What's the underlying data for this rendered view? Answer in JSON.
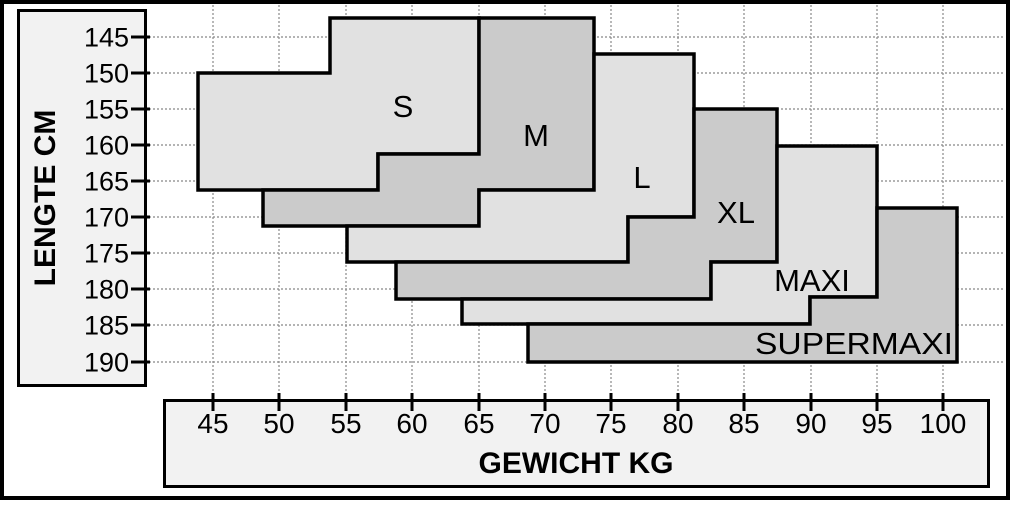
{
  "axes": {
    "y": {
      "title": "LENGTE CM",
      "unit": "cm",
      "ticks": [
        {
          "label": "145",
          "px": 37
        },
        {
          "label": "150",
          "px": 73
        },
        {
          "label": "155",
          "px": 109
        },
        {
          "label": "160",
          "px": 145
        },
        {
          "label": "165",
          "px": 181
        },
        {
          "label": "170",
          "px": 217
        },
        {
          "label": "175",
          "px": 253
        },
        {
          "label": "180",
          "px": 289
        },
        {
          "label": "185",
          "px": 325
        },
        {
          "label": "190",
          "px": 362
        }
      ]
    },
    "x": {
      "title": "GEWICHT KG",
      "unit": "kg",
      "ticks": [
        {
          "label": "45",
          "px": 213
        },
        {
          "label": "50",
          "px": 279
        },
        {
          "label": "55",
          "px": 346
        },
        {
          "label": "60",
          "px": 412
        },
        {
          "label": "65",
          "px": 479
        },
        {
          "label": "70",
          "px": 545
        },
        {
          "label": "75",
          "px": 611
        },
        {
          "label": "80",
          "px": 678
        },
        {
          "label": "85",
          "px": 744
        },
        {
          "label": "90",
          "px": 811
        },
        {
          "label": "95",
          "px": 877
        },
        {
          "label": "100",
          "px": 943
        }
      ]
    }
  },
  "colors": {
    "region_light": "#e1e1e1",
    "region_dark": "#cbcbcb",
    "axis_box": "#f2f2f2",
    "grid": "#888888",
    "line": "#000000",
    "background": "#ffffff"
  },
  "grid": {
    "h_x1": 149,
    "h_x2": 1005,
    "v_y1": 5,
    "v_y2": 399,
    "left_tick_x1": 131,
    "left_tick_x2": 150,
    "bottom_tick_y1": 393,
    "bottom_tick_y2": 411
  },
  "chart_data": {
    "type": "area",
    "subtype": "stepped-size-regions",
    "title": "",
    "xlabel": "GEWICHT KG",
    "ylabel": "LENGTE CM",
    "x_domain": [
      45,
      100
    ],
    "y_domain": [
      145,
      190
    ],
    "y_inverted": true,
    "grid": "dashed, on both axes at every 5 units",
    "legend_position": "labels inside regions",
    "regions": [
      {
        "name": "S",
        "shade": "light",
        "points_px": [
          [
            198,
            73
          ],
          [
            330,
            73
          ],
          [
            330,
            18
          ],
          [
            479,
            18
          ],
          [
            479,
            154
          ],
          [
            378,
            154
          ],
          [
            378,
            190
          ],
          [
            198,
            190
          ]
        ],
        "points_data_kg_cm": [
          [
            44,
            150
          ],
          [
            54,
            150
          ],
          [
            54,
            142.5
          ],
          [
            65,
            142.5
          ],
          [
            65,
            161
          ],
          [
            57.5,
            161
          ],
          [
            57.5,
            166.5
          ],
          [
            44,
            166.5
          ]
        ],
        "label_px": [
          403,
          117
        ]
      },
      {
        "name": "M",
        "shade": "dark",
        "points_px": [
          [
            479,
            18
          ],
          [
            594,
            18
          ],
          [
            594,
            190
          ],
          [
            479,
            190
          ],
          [
            479,
            226
          ],
          [
            263,
            226
          ],
          [
            263,
            190
          ],
          [
            378,
            190
          ],
          [
            378,
            154
          ],
          [
            479,
            154
          ]
        ],
        "points_data_kg_cm": [
          [
            65,
            142.5
          ],
          [
            74,
            142.5
          ],
          [
            74,
            166.5
          ],
          [
            65,
            166.5
          ],
          [
            65,
            171.5
          ],
          [
            49,
            171.5
          ],
          [
            49,
            166.5
          ],
          [
            57.5,
            166.5
          ],
          [
            57.5,
            161
          ],
          [
            65,
            161
          ]
        ],
        "label_px": [
          536,
          146
        ]
      },
      {
        "name": "L",
        "shade": "light",
        "points_px": [
          [
            594,
            54
          ],
          [
            694,
            54
          ],
          [
            694,
            217
          ],
          [
            628,
            217
          ],
          [
            628,
            262
          ],
          [
            347,
            262
          ],
          [
            347,
            226
          ],
          [
            479,
            226
          ],
          [
            479,
            190
          ],
          [
            594,
            190
          ]
        ],
        "points_data_kg_cm": [
          [
            74,
            147.5
          ],
          [
            81,
            147.5
          ],
          [
            81,
            170
          ],
          [
            76,
            170
          ],
          [
            76,
            176
          ],
          [
            55,
            176
          ],
          [
            55,
            171.5
          ],
          [
            65,
            171.5
          ],
          [
            65,
            166.5
          ],
          [
            74,
            166.5
          ]
        ],
        "label_px": [
          642,
          188
        ]
      },
      {
        "name": "XL",
        "shade": "dark",
        "points_px": [
          [
            694,
            109
          ],
          [
            777,
            109
          ],
          [
            777,
            262
          ],
          [
            711,
            262
          ],
          [
            711,
            299
          ],
          [
            396,
            299
          ],
          [
            396,
            262
          ],
          [
            628,
            262
          ],
          [
            628,
            217
          ],
          [
            694,
            217
          ]
        ],
        "points_data_kg_cm": [
          [
            81,
            155
          ],
          [
            87.5,
            155
          ],
          [
            87.5,
            176
          ],
          [
            82.5,
            176
          ],
          [
            82.5,
            181.5
          ],
          [
            59,
            181.5
          ],
          [
            59,
            176
          ],
          [
            76,
            176
          ],
          [
            76,
            170
          ],
          [
            81,
            170
          ]
        ],
        "label_px": [
          736,
          223
        ]
      },
      {
        "name": "MAXI",
        "shade": "light",
        "points_px": [
          [
            777,
            146
          ],
          [
            877,
            146
          ],
          [
            877,
            297
          ],
          [
            810,
            297
          ],
          [
            810,
            324
          ],
          [
            462,
            324
          ],
          [
            462,
            299
          ],
          [
            711,
            299
          ],
          [
            711,
            262
          ],
          [
            777,
            262
          ]
        ],
        "points_data_kg_cm": [
          [
            87.5,
            160
          ],
          [
            95,
            160
          ],
          [
            95,
            181
          ],
          [
            90,
            181
          ],
          [
            90,
            185
          ],
          [
            64,
            185
          ],
          [
            64,
            181.5
          ],
          [
            82.5,
            181.5
          ],
          [
            82.5,
            176
          ],
          [
            87.5,
            176
          ]
        ],
        "label_px": [
          812,
          291
        ]
      },
      {
        "name": "SUPERMAXI",
        "shade": "dark",
        "points_px": [
          [
            877,
            208
          ],
          [
            957,
            208
          ],
          [
            957,
            362
          ],
          [
            528,
            362
          ],
          [
            528,
            324
          ],
          [
            810,
            324
          ],
          [
            810,
            297
          ],
          [
            877,
            297
          ]
        ],
        "points_data_kg_cm": [
          [
            95,
            169
          ],
          [
            101,
            169
          ],
          [
            101,
            190
          ],
          [
            69,
            190
          ],
          [
            69,
            185
          ],
          [
            90,
            185
          ],
          [
            90,
            181
          ],
          [
            95,
            181
          ]
        ],
        "label_px": [
          854,
          354
        ],
        "label_text_length": 198
      }
    ]
  }
}
